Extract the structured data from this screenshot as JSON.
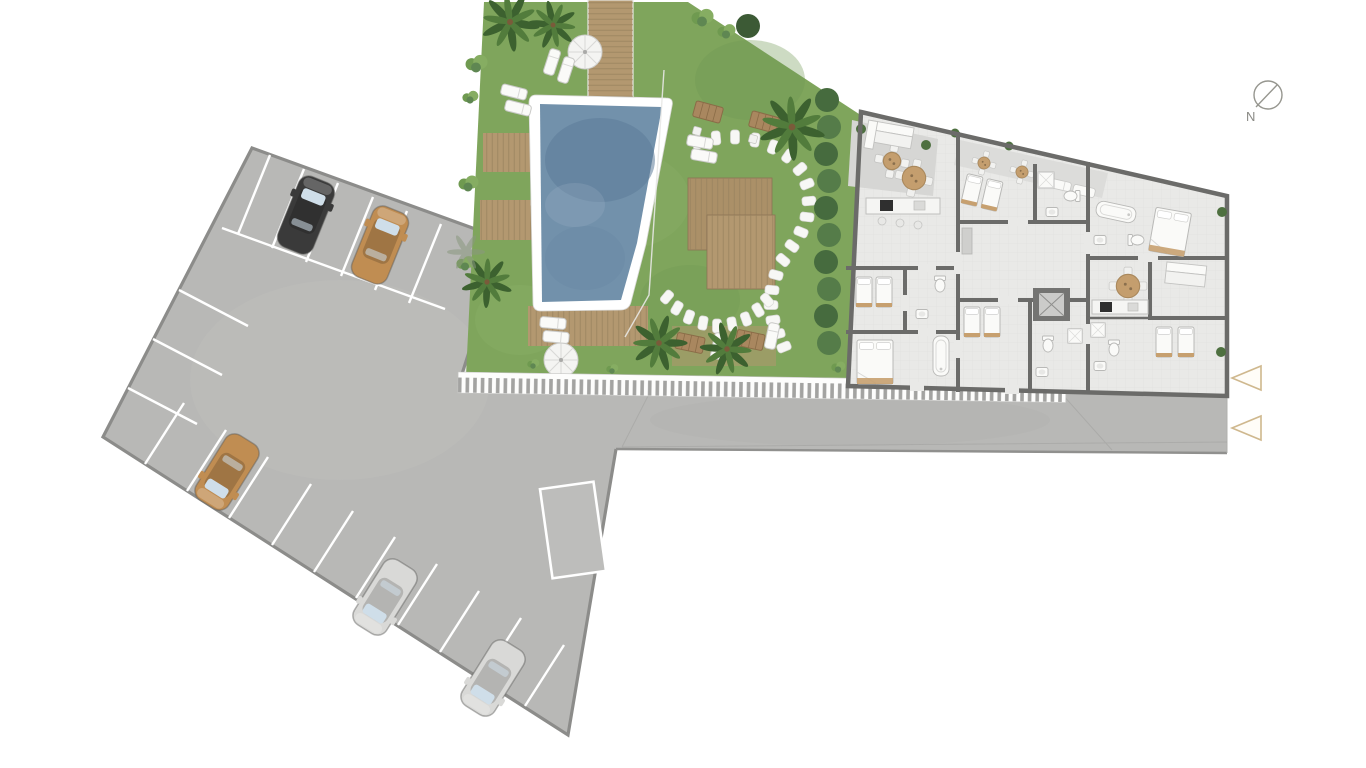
{
  "scene": {
    "kind": "architectural-site-plan",
    "view": "top-down ground floor plan with parking lot, pool garden and apartment building"
  },
  "compass": {
    "label": "N"
  },
  "markers": {
    "entrance_arrows": 2
  },
  "colors": {
    "background": "#ffffff",
    "pavement": "#b8b8b6",
    "pavement_border": "#8c8c8a",
    "stall_line": "#ffffff",
    "grass": "#7fa55c",
    "pool_water": "#7291ab",
    "pool_border": "#ffffff",
    "deck_wood": "#b39870",
    "deck_line": "#97815d",
    "palm_green": "#3f6b38",
    "hedge_green": "#48663e",
    "building_floor": "#e9e9e7",
    "wall": "#6b6b69",
    "terrace": "#d6d6d4",
    "furniture_white": "#fafaf8",
    "accent_tan": "#c49e6e",
    "hatch_tick": "#a3a3a1",
    "marker_outline": "#cfb88e",
    "compass_gray": "#96968f",
    "windshield": "#cfdee9"
  },
  "parking": {
    "cars": [
      {
        "name": "car-1",
        "color_name": "black",
        "color": "#3a3a3a"
      },
      {
        "name": "car-2",
        "color_name": "tan",
        "color": "#c08d52"
      },
      {
        "name": "car-3",
        "color_name": "tan",
        "color": "#c08d52"
      },
      {
        "name": "car-4",
        "color_name": "silver",
        "color": "#d9d9d7"
      },
      {
        "name": "car-5",
        "color_name": "silver",
        "color": "#d9d9d7"
      }
    ],
    "marked_stall_rows": 3
  },
  "garden": {
    "features": [
      "swimming-pool",
      "wood-decks",
      "parasols",
      "sun-loungers",
      "palm-trees",
      "stepping-stone-path",
      "pergola-deck",
      "planter",
      "hedge"
    ],
    "parasols": 2,
    "palm_trees": 6,
    "stepping_stones": 28
  },
  "building": {
    "kind": "apartment-floor-plan",
    "features": [
      "bedrooms",
      "bathrooms",
      "kitchens",
      "dining-tables",
      "sofas",
      "terraces",
      "elevator-core"
    ]
  }
}
